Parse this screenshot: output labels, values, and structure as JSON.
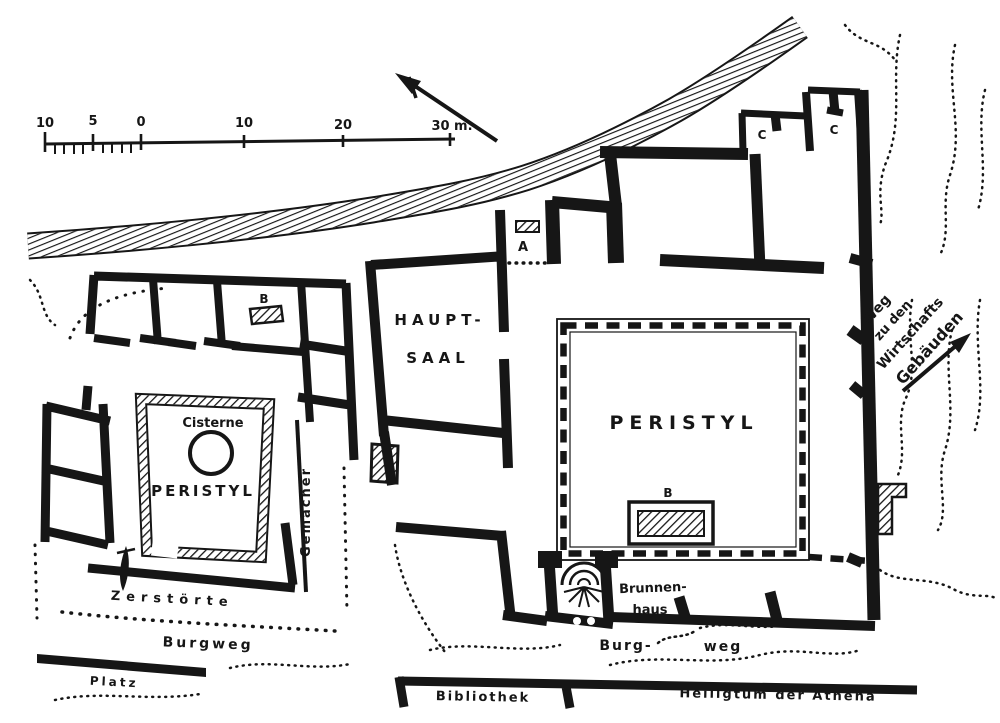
{
  "meta": {
    "type": "architectural-plan",
    "ink_color": "#161616",
    "paper_color": "#ffffff"
  },
  "scale_bar": {
    "labels": [
      "10",
      "5",
      "0",
      "10",
      "20",
      "30 m."
    ]
  },
  "left_house": {
    "court_label": "PERISTYL",
    "cistern_label": "Cisterne",
    "marker_b": "B",
    "corridor_label": "Gemächer",
    "destroyed_line1": "Zerstörte",
    "destroyed_line2": "Burgweg"
  },
  "right_house": {
    "hall_line1": "HAUPT-",
    "hall_line2": "SAAL",
    "court_label": "PERISTYL",
    "marker_a": "A",
    "marker_b": "B",
    "marker_c_left": "C",
    "marker_c_right": "C",
    "well_line1": "Brunnen-",
    "well_line2": "haus"
  },
  "streets": {
    "burg": "Burg-",
    "weg": "weg",
    "platz": "Platz"
  },
  "south_buildings": {
    "library": "Bibliothek",
    "sanctuary": "Heiligtum der Athena"
  },
  "east_path": {
    "line1": "Weg",
    "line2": "zu den",
    "line3": "Wirtschafts",
    "line4": "Gebäuden"
  }
}
